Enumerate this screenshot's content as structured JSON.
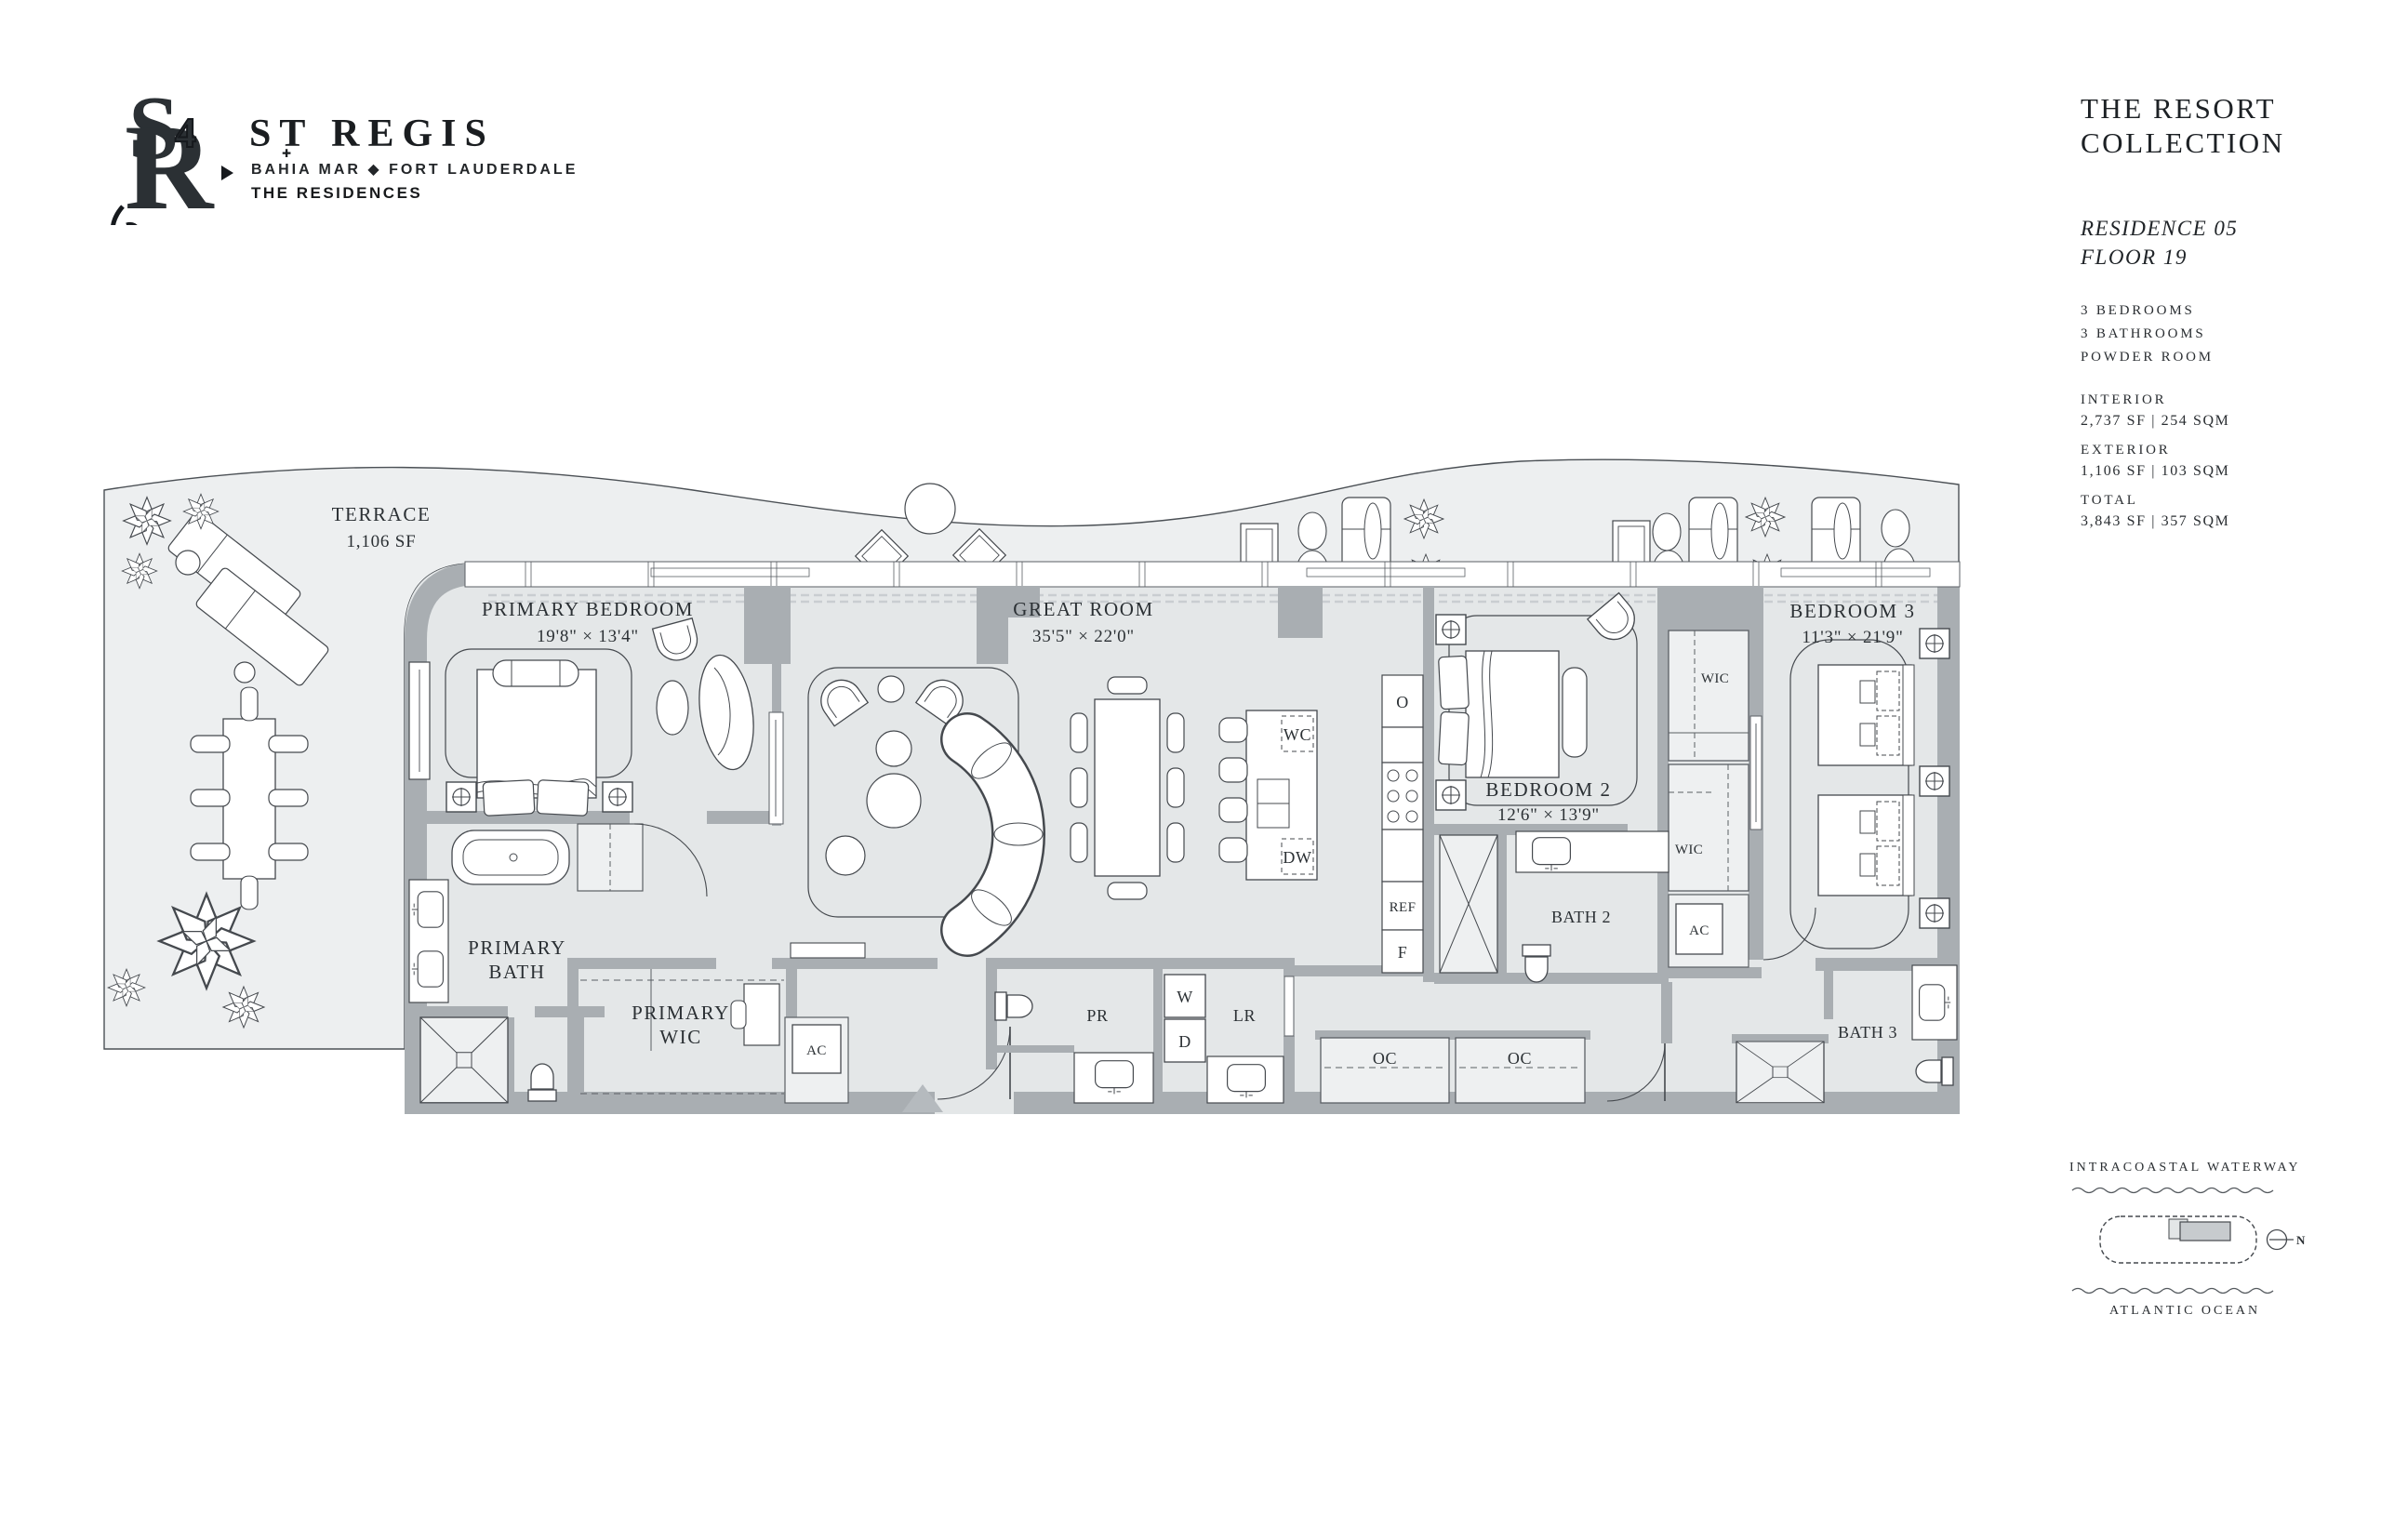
{
  "header": {
    "brand": "ST REGIS",
    "brand_mark": "✚",
    "location": "BAHIA MAR ◆ FORT LAUDERDALE",
    "residences": "THE RESIDENCES",
    "monogram": {
      "s": "S",
      "r": "R",
      "four": "4"
    }
  },
  "sidebar": {
    "collection_line1": "THE RESORT",
    "collection_line2": "COLLECTION",
    "residence": "RESIDENCE 05",
    "floor": "FLOOR 19",
    "features": [
      "3 BEDROOMS",
      "3 BATHROOMS",
      "POWDER ROOM"
    ],
    "stats": [
      {
        "label": "INTERIOR",
        "value": "2,737 SF | 254 SQM"
      },
      {
        "label": "EXTERIOR",
        "value": "1,106 SF | 103 SQM"
      },
      {
        "label": "TOTAL",
        "value": "3,843 SF | 357 SQM"
      }
    ]
  },
  "plan": {
    "terrace": {
      "name": "TERRACE",
      "area": "1,106 SF"
    },
    "primary_bedroom": {
      "name": "PRIMARY BEDROOM",
      "dims": "19'8\" × 13'4\""
    },
    "great_room": {
      "name": "GREAT ROOM",
      "dims": "35'5\" × 22'0\""
    },
    "bedroom2": {
      "name": "BEDROOM 2",
      "dims": "12'6\" × 13'9\""
    },
    "bedroom3": {
      "name": "BEDROOM 3",
      "dims": "11'3\" × 21'9\""
    },
    "primary_bath": {
      "line1": "PRIMARY",
      "line2": "BATH"
    },
    "primary_wic": {
      "line1": "PRIMARY",
      "line2": "WIC"
    },
    "bath2": "BATH 2",
    "bath3": "BATH 3",
    "wic": "WIC",
    "ac": "AC",
    "appliances": {
      "oven": "O",
      "fridge": "REF",
      "freezer": "F",
      "wine_cooler": "WC",
      "dishwasher": "DW",
      "washer": "W",
      "dryer": "D"
    },
    "powder_room": "PR",
    "laundry_room": "LR",
    "closet": "OC"
  },
  "keyplan": {
    "waterway": "INTRACOASTAL WATERWAY",
    "ocean": "ATLANTIC OCEAN",
    "north": "N"
  },
  "colors": {
    "ink": "#2b3034",
    "wall": "#a9aeb2",
    "floor": "#e4e7e8",
    "terrace": "#edeff0"
  }
}
